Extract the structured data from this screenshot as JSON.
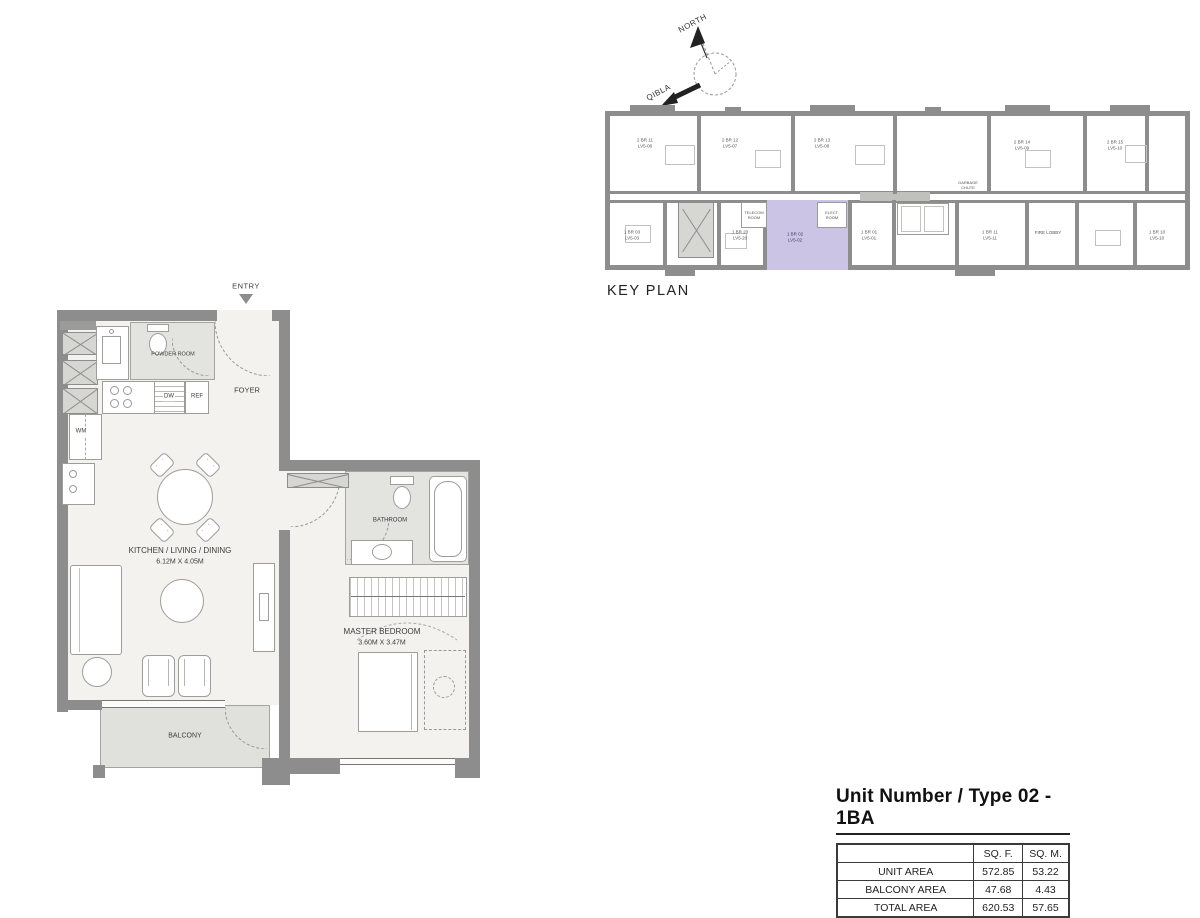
{
  "colors": {
    "wall": "#8d8d8d",
    "floor": "#f3f2ee",
    "wet_room": "#e3e3df",
    "balcony": "#e0e0dc",
    "highlight_unit": "#cbc4e4"
  },
  "compass": {
    "north_label": "NORTH",
    "qibla_label": "QIBLA"
  },
  "keyplan": {
    "title": "KEY PLAN",
    "units": [
      {
        "label": "2 BR 11\nLV5-06"
      },
      {
        "label": "2 BR 12\nLV5-07"
      },
      {
        "label": "2 BR 13\nLV5-08"
      },
      {
        "label": "2 BR 14\nLV5-09"
      },
      {
        "label": "2 BR 15\nLV5-10"
      },
      {
        "label": "1 BR 03\nLV5-03"
      },
      {
        "label": "1 BR 20\nLV5-20"
      },
      {
        "label": "1 BR 02\nLV5-02"
      },
      {
        "label": "1 BR 01\nLV5-01"
      },
      {
        "label": "1 BR 11\nLV5-11"
      },
      {
        "label": "FIRE LOBBY"
      },
      {
        "label": "1 BR 10\nLV5-10"
      },
      {
        "label": "TELECOM\nROOM"
      },
      {
        "label": "ELECT.\nROOM"
      },
      {
        "label": "GARBAGE\nCHUTE"
      }
    ]
  },
  "floorplan": {
    "entry_label": "ENTRY",
    "powder_room_label": "POWDER ROOM",
    "foyer_label": "FOYER",
    "kitchen_label": "KITCHEN / LIVING / DINING",
    "kitchen_dimensions": "6.12M X 4.05M",
    "master_bedroom_label": "MASTER BEDROOM",
    "master_bedroom_dimensions": "3.60M X 3.47M",
    "bathroom_label": "BATHROOM",
    "balcony_label": "BALCONY",
    "appliance_dw_label": "DW",
    "appliance_ref_label": "REF",
    "appliance_wm_label": "WM"
  },
  "area_table": {
    "title": "Unit Number / Type 02 - 1BA",
    "columns": {
      "area": "",
      "sqf": "SQ. F.",
      "sqm": "SQ. M."
    },
    "rows": [
      {
        "label": "UNIT AREA",
        "sqf": "572.85",
        "sqm": "53.22"
      },
      {
        "label": "BALCONY AREA",
        "sqf": "47.68",
        "sqm": "4.43"
      },
      {
        "label": "TOTAL AREA",
        "sqf": "620.53",
        "sqm": "57.65"
      }
    ]
  }
}
